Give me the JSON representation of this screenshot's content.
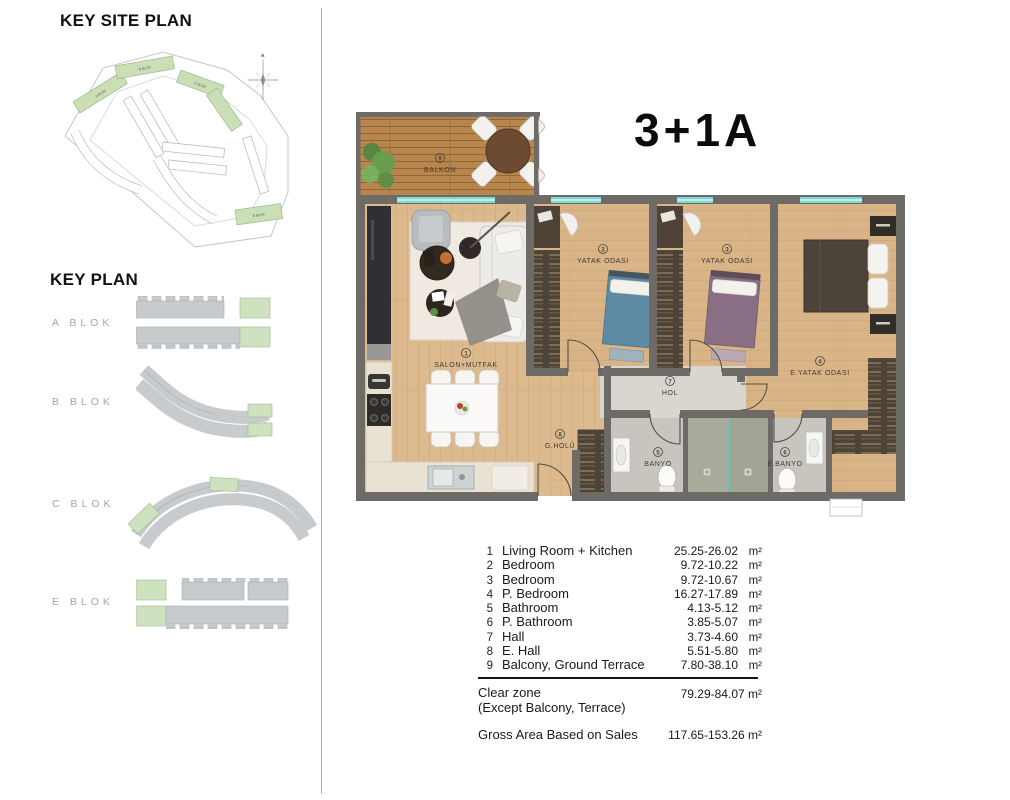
{
  "left_panel": {
    "site_plan_heading": "KEY SITE PLAN",
    "key_plan_heading": "KEY PLAN",
    "compass_label": "K",
    "site_labels": {
      "a": "A BLOK",
      "b": "B BLOK",
      "c": "C BLOK",
      "e": "E BLOK"
    },
    "key_plan_items": [
      {
        "label": "A BLOK"
      },
      {
        "label": "B BLOK"
      },
      {
        "label": "C BLOK"
      },
      {
        "label": "E BLOK"
      }
    ]
  },
  "plan": {
    "title": "3+1A",
    "room_labels": {
      "balcony": {
        "num": "9",
        "text": "BALKON"
      },
      "living": {
        "num": "1",
        "text": "SALON+MUTFAK"
      },
      "bedroom2": {
        "num": "2",
        "text": "YATAK ODASI"
      },
      "bedroom3": {
        "num": "3",
        "text": "YATAK ODASI"
      },
      "master": {
        "num": "4",
        "text": "E.YATAK ODASI"
      },
      "hall": {
        "num": "7",
        "text": "HOL"
      },
      "entry": {
        "num": "8",
        "text": "G.HOLÜ"
      },
      "bath": {
        "num": "5",
        "text": "BANYO"
      },
      "master_bath": {
        "num": "6",
        "text": "E.BANYO"
      }
    }
  },
  "legend": {
    "rows": [
      {
        "no": "1",
        "name": "Living Room + Kitchen",
        "area": "25.25-26.02",
        "unit": "m²"
      },
      {
        "no": "2",
        "name": "Bedroom",
        "area": "9.72-10.22",
        "unit": "m²"
      },
      {
        "no": "3",
        "name": "Bedroom",
        "area": "9.72-10.67",
        "unit": "m²"
      },
      {
        "no": "4",
        "name": "P. Bedroom",
        "area": "16.27-17.89",
        "unit": "m²"
      },
      {
        "no": "5",
        "name": "Bathroom",
        "area": "4.13-5.12",
        "unit": "m²"
      },
      {
        "no": "6",
        "name": "P. Bathroom",
        "area": "3.85-5.07",
        "unit": "m²"
      },
      {
        "no": "7",
        "name": "Hall",
        "area": "3.73-4.60",
        "unit": "m²"
      },
      {
        "no": "8",
        "name": "E. Hall",
        "area": "5.51-5.80",
        "unit": "m²"
      },
      {
        "no": "9",
        "name": "Balcony, Ground Terrace",
        "area": "7.80-38.10",
        "unit": "m²"
      }
    ],
    "clear_zone_label": "Clear zone",
    "clear_zone_sub": "(Except Balcony, Terrace)",
    "clear_zone_value": "79.29-84.07 m²",
    "gross_label": "Gross Area Based on Sales",
    "gross_value": "117.65-153.26 m²"
  },
  "colors": {
    "wall": "#6e6a66",
    "wood_floor": "#dcba8e",
    "deck": "#b8854e",
    "window_teal": "#7ed8d3",
    "highlight_green": "#cadfb6",
    "block_gray": "#c7cbce",
    "hall_tile": "#d9d6d0",
    "bath_tile": "#c7c5be",
    "shower_tile": "#a9ab9c"
  }
}
